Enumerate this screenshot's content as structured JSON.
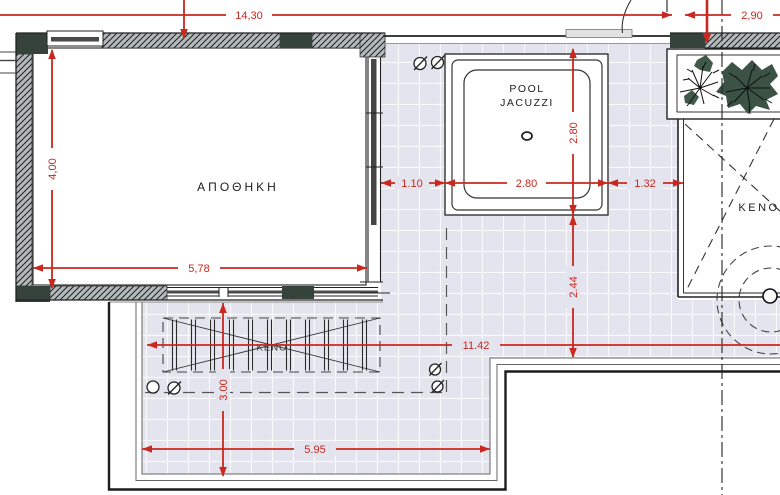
{
  "plan": {
    "rooms": {
      "storage": "ΑΠΟΘΗΚΗ",
      "pool_line1": "POOL",
      "pool_line2": "JACUZZI",
      "void_right": "ΚΕΝΟ",
      "void_pergola": "ΚΕΝΟ"
    },
    "dims": {
      "top_total": "14,30",
      "top_right": "2,90",
      "storage_height": "4,00",
      "storage_width": "5,78",
      "pool_offset_left": "1.10",
      "pool_width": "2.80",
      "pool_offset_right": "1.32",
      "pool_depth": "2.80",
      "pool_to_step": "2.44",
      "terrace_length": "11.42",
      "pergola_depth": "3.00",
      "lower_terrace_length": "5.95"
    },
    "colors": {
      "dimension_red": "#c8281e",
      "tile_lavender": "#e4e4ee",
      "hatch_grey": "#b4babc",
      "column_dark": "#35433b",
      "plant_green": "#3b5244",
      "line_black": "#222222"
    }
  }
}
